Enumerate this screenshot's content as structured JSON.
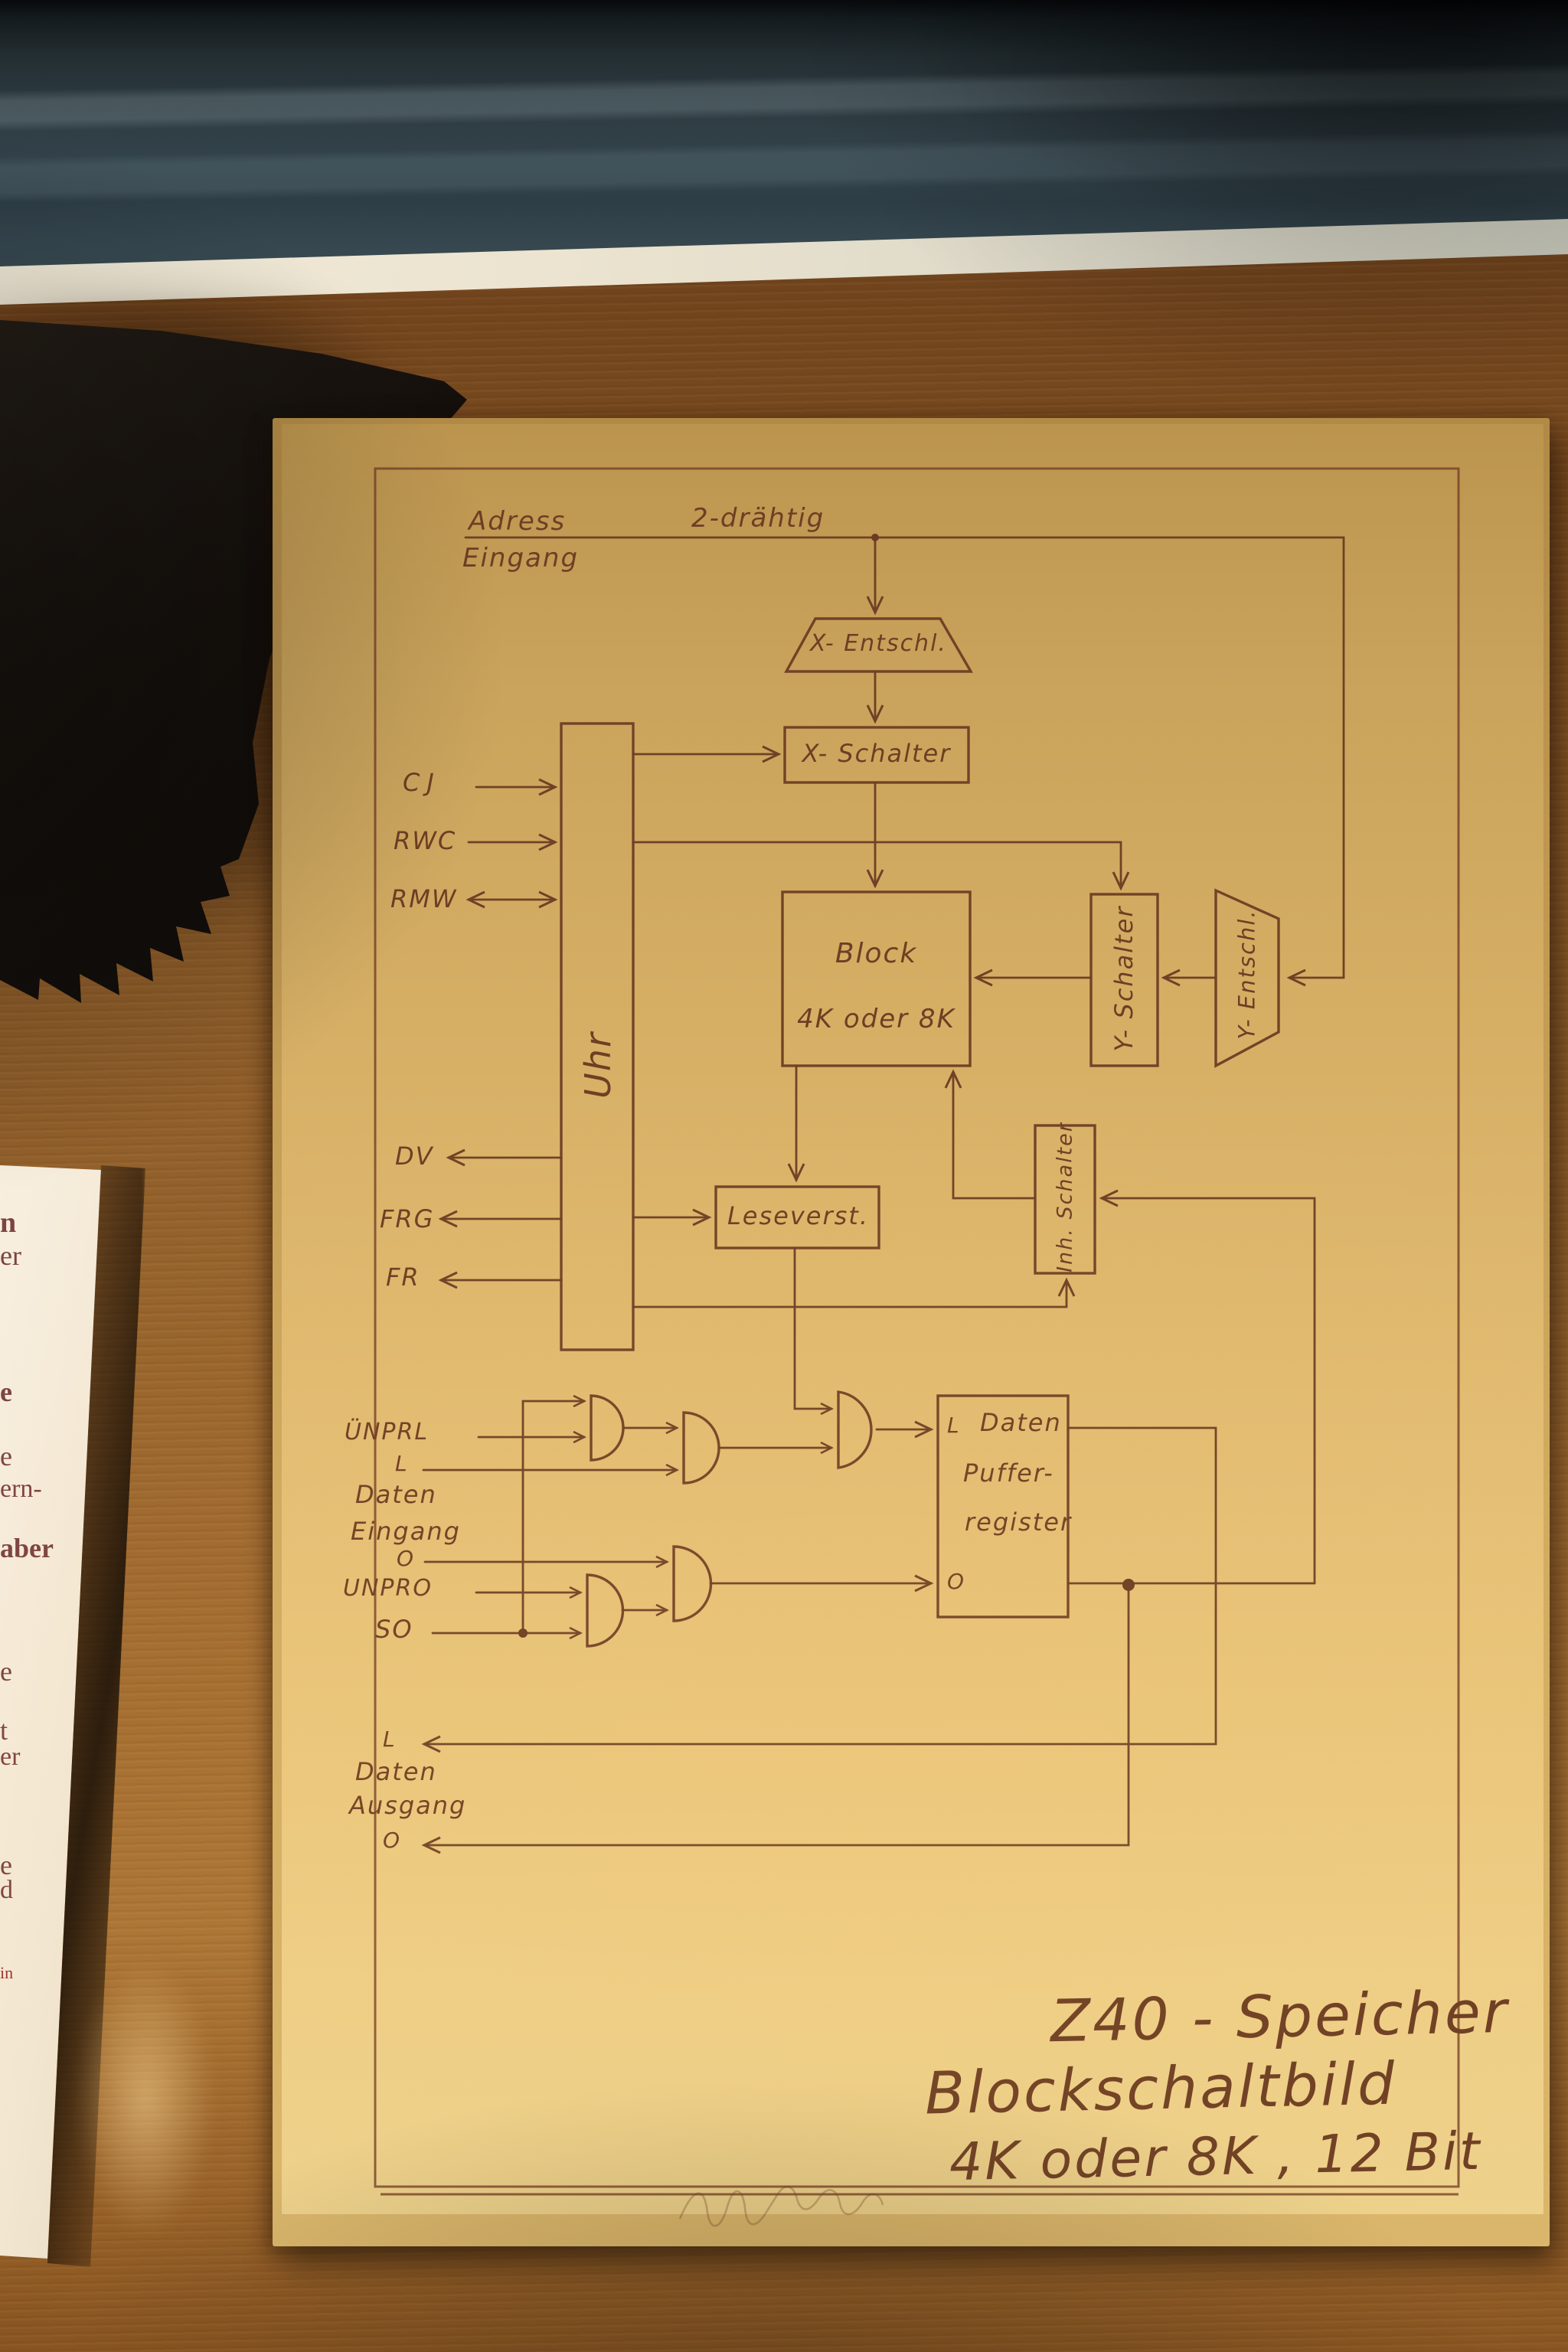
{
  "colors": {
    "ink": "#6b3c23",
    "paper": "#e0ba70",
    "wood": "#96632c",
    "glass_band": "#33434b",
    "card_text": "#7d4341",
    "card_accent": "#a03030"
  },
  "diagram": {
    "header": {
      "adress": "Adress",
      "eingang": "Eingang",
      "zweidraht": "2-drähtig"
    },
    "blocks": {
      "x_entschl": "X- Entschl.",
      "x_schalter": "X- Schalter",
      "uhr": "Uhr",
      "block_line1": "Block",
      "block_line2": "4K oder 8K",
      "y_schalter": "Y- Schalter",
      "y_entschl": "Y- Entschl.",
      "leseverst": "Leseverst.",
      "inh_schalter": "Inh. Schalter",
      "register_l": "L",
      "register_daten": "Daten",
      "register_puffer": "Puffer-",
      "register_register": "register",
      "register_o": "O"
    },
    "signals_in": [
      "CJ",
      "RWC",
      "RMW"
    ],
    "signals_out": [
      "DV",
      "FRG",
      "FR"
    ],
    "data_input": {
      "unprl": "ÜNPRL",
      "l": "L",
      "daten": "Daten",
      "eingang": "Eingang",
      "o": "O",
      "unpro": "UNPRO",
      "so": "SO"
    },
    "data_output": {
      "l": "L",
      "daten": "Daten",
      "ausgang": "Ausgang",
      "o": "O"
    },
    "title_lines": [
      "Z40 - Speicher",
      "Blockschaltbild",
      "4K oder 8K , 12 Bit"
    ]
  },
  "museum_card": {
    "fragments": [
      "n",
      "er",
      "e",
      "e",
      "ern-",
      "aber",
      "e",
      "t",
      "er",
      "e",
      "d",
      "in"
    ]
  }
}
